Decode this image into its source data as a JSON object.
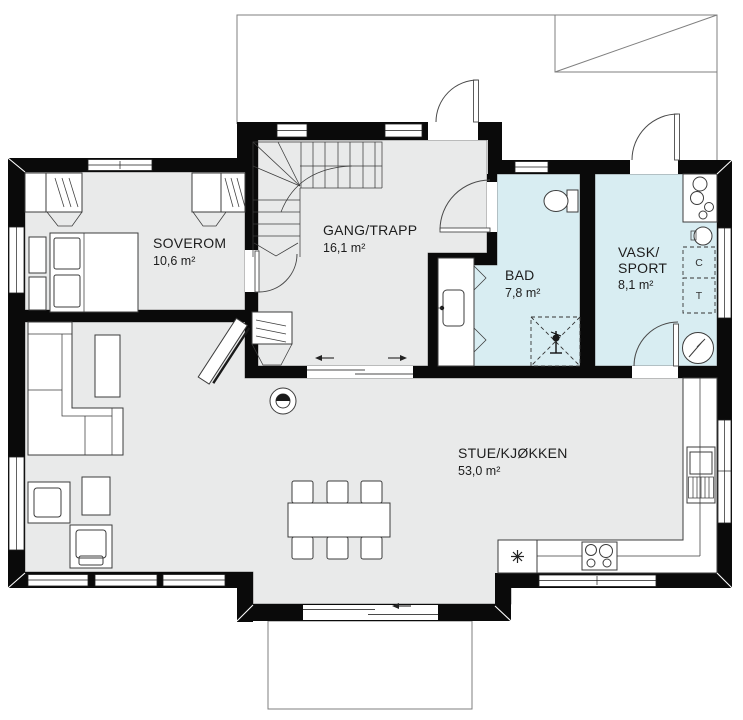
{
  "plan": {
    "rooms": [
      {
        "id": "soverom",
        "name": "SOVEROM",
        "area": "10,6 m²"
      },
      {
        "id": "gang-trapp",
        "name": "GANG/TRAPP",
        "area": "16,1 m²"
      },
      {
        "id": "bad",
        "name": "BAD",
        "area": "7,8 m²"
      },
      {
        "id": "vask-sport",
        "name_line1": "VASK/",
        "name_line2": "SPORT",
        "area": "8,1 m²"
      },
      {
        "id": "stue-kjokken",
        "name": "STUE/KJØKKEN",
        "area": "53,0 m²"
      }
    ],
    "appliance_labels": {
      "dryer": "C",
      "washer": "T"
    },
    "colors": {
      "wall": "#0a0a0a",
      "floor": "#e9eaea",
      "wet_room": "#d8edf2",
      "furniture_line": "#3c3c3c",
      "outline": "#7f7f7f",
      "label_text": "#1d1d1d"
    }
  }
}
